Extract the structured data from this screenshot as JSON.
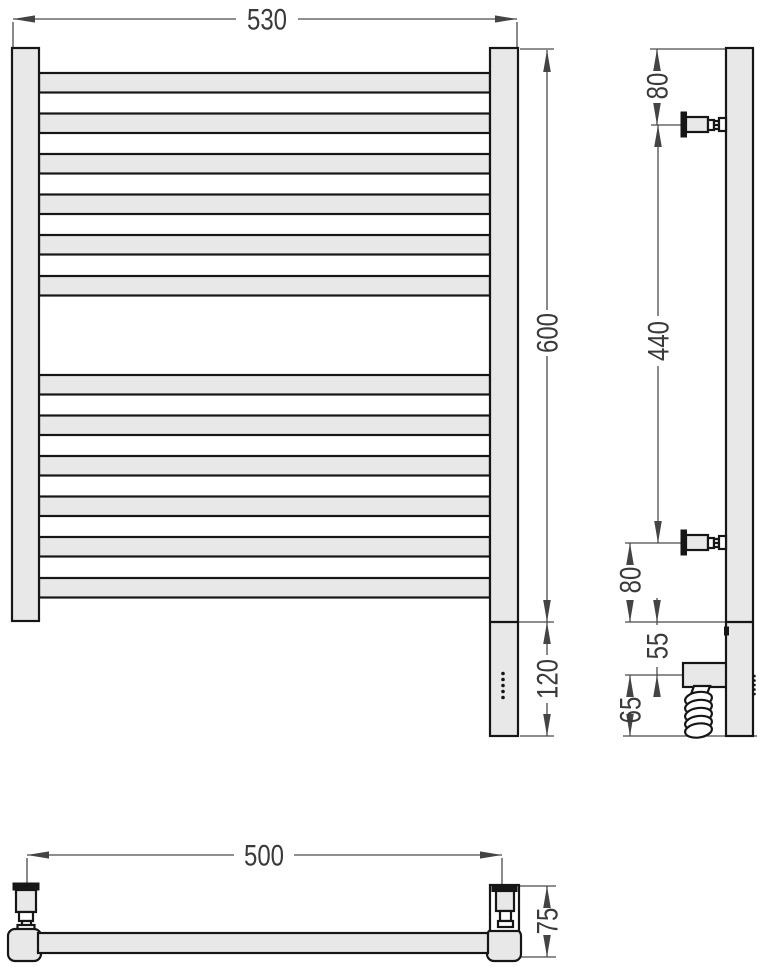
{
  "colors": {
    "part_fill": "#e8e8e8",
    "part_stroke": "#161616",
    "dim_color": "#4a4a4a",
    "text_color": "#3a3a3a"
  },
  "views": {
    "front": {
      "dims": {
        "width": "530",
        "height": "600",
        "heater_section": "120"
      }
    },
    "side": {
      "dims": {
        "top_to_bracket": "80",
        "bracket_span": "440",
        "bracket_to_bottom": "80",
        "element_offset": "55",
        "element_to_end": "65"
      }
    },
    "top": {
      "dims": {
        "mount_centers": "500",
        "depth": "75"
      }
    }
  }
}
